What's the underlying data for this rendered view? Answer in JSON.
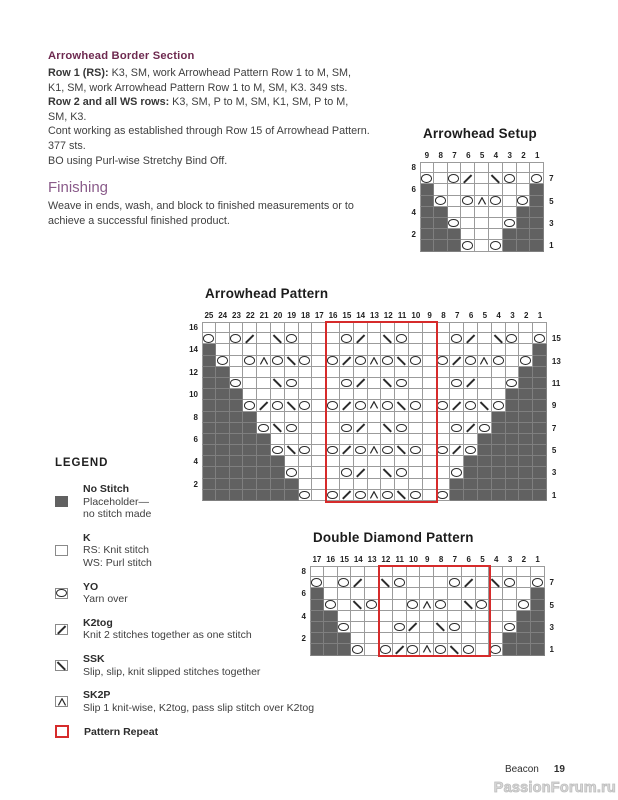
{
  "instructions": {
    "heading": "Arrowhead Border Section",
    "paragraphs": [
      {
        "label": "Row 1 (RS):",
        "text": " K3, SM, work Arrowhead Pattern Row 1 to M, SM, K1, SM, work Arrowhead Pattern Row 1 to M, SM, K3. 349 sts."
      },
      {
        "label": "Row 2 and all WS rows:",
        "text": " K3, SM, P to M, SM, K1, SM, P to M, SM, K3."
      },
      {
        "label": "",
        "text": "Cont working as established through Row 15 of Arrowhead Pattern. 377 sts."
      },
      {
        "label": "",
        "text": "BO using Purl-wise Stretchy Bind Off."
      }
    ],
    "finishing_heading": "Finishing",
    "finishing_text": "Weave in ends, wash, and block to finished measurements or to achieve a successful finished product."
  },
  "legend": {
    "heading": "LEGEND",
    "items": [
      {
        "symbol": "#",
        "name": "No Stitch",
        "desc": [
          "Placeholder—",
          "no stitch made"
        ]
      },
      {
        "symbol": ".",
        "name": "K",
        "desc": [
          "RS: Knit stitch",
          "WS: Purl stitch"
        ]
      },
      {
        "symbol": "O",
        "name": "YO",
        "desc": [
          "Yarn over"
        ]
      },
      {
        "symbol": "/",
        "name": "K2tog",
        "desc": [
          "Knit 2 stitches together as one stitch"
        ]
      },
      {
        "symbol": "\\",
        "name": "SSK",
        "desc": [
          "Slip, slip, knit slipped stitches together"
        ]
      },
      {
        "symbol": "A",
        "name": "SK2P",
        "desc": [
          "Slip 1 knit-wise, K2tog, pass slip stitch over K2tog"
        ]
      },
      {
        "symbol": "R",
        "name": "Pattern Repeat",
        "desc": []
      }
    ]
  },
  "symbol_key": {
    "#": "no stitch",
    ".": "knit",
    "O": "yarn over",
    "/": "k2tog",
    "\\": "ssk",
    "A": "sk2p"
  },
  "charts": [
    {
      "title": "Arrowhead Setup",
      "columns": [
        "9",
        "8",
        "7",
        "6",
        "5",
        "4",
        "3",
        "2",
        "1"
      ],
      "left_labels": [
        "8",
        "",
        "6",
        "",
        "4",
        "",
        "2",
        ""
      ],
      "right_labels": [
        "",
        "7",
        "",
        "5",
        "",
        "3",
        "",
        "1"
      ],
      "rows": [
        ".........",
        "O.O/.\\O.O",
        "#.......#",
        "#O.OAO.O#",
        "##.....##",
        "##O...O##",
        "###...###",
        "###O.O###"
      ],
      "repeat_box": null
    },
    {
      "title": "Arrowhead Pattern",
      "columns": [
        "25",
        "24",
        "23",
        "22",
        "21",
        "20",
        "19",
        "18",
        "17",
        "16",
        "15",
        "14",
        "13",
        "12",
        "11",
        "10",
        "9",
        "8",
        "7",
        "6",
        "5",
        "4",
        "3",
        "2",
        "1"
      ],
      "left_labels": [
        "16",
        "",
        "14",
        "",
        "12",
        "",
        "10",
        "",
        "8",
        "",
        "6",
        "",
        "4",
        "",
        "2",
        ""
      ],
      "right_labels": [
        "",
        "15",
        "",
        "13",
        "",
        "11",
        "",
        "9",
        "",
        "7",
        "",
        "5",
        "",
        "3",
        "",
        "1"
      ],
      "rows": [
        ".........................",
        "O.O/.\\O...O/.\\O...O/.\\O.O",
        "#.......................#",
        "#O.OAO\\O.O/OAO\\O.O/OAO.O#",
        "##.....................##",
        "##O..\\O...O/.\\O...O/..O##",
        "###...................###",
        "###O/O\\O.O/OAO\\O.O/O\\O###",
        "####.................####",
        "####O\\O...O/.\\O...O/O####",
        "#####...............#####",
        "#####O\\O.O/OAO\\O.O/O#####",
        "######.............######",
        "######O...O/.\\O...O######",
        "#######...........#######",
        "#######O.O/OAO\\O.O#######"
      ],
      "repeat_box": {
        "start_col": 16,
        "end_col": 9
      }
    },
    {
      "title": "Double Diamond Pattern",
      "columns": [
        "17",
        "16",
        "15",
        "14",
        "13",
        "12",
        "11",
        "10",
        "9",
        "8",
        "7",
        "6",
        "5",
        "4",
        "3",
        "2",
        "1"
      ],
      "left_labels": [
        "8",
        "",
        "6",
        "",
        "4",
        "",
        "2",
        ""
      ],
      "right_labels": [
        "",
        "7",
        "",
        "5",
        "",
        "3",
        "",
        "1"
      ],
      "rows": [
        ".................",
        "O.O/.\\O...O/.\\O.O",
        "#...............#",
        "#O.\\O..OAO.\\O..O#",
        "##.............##",
        "##O...O/.\\O...O##",
        "###...........###",
        "###O.O/OAO\\O.O###"
      ],
      "repeat_box": {
        "start_col": 12,
        "end_col": 5
      }
    }
  ],
  "page": {
    "footer": {
      "brand": "Beacon",
      "page_number": "19",
      "watermark": "PassionForum.ru"
    }
  },
  "colors": {
    "heading_purple": "#6e2a50",
    "finishing_purple": "#8a5b8a",
    "no_stitch_gray": "#616161",
    "repeat_red": "#d62b2b"
  }
}
